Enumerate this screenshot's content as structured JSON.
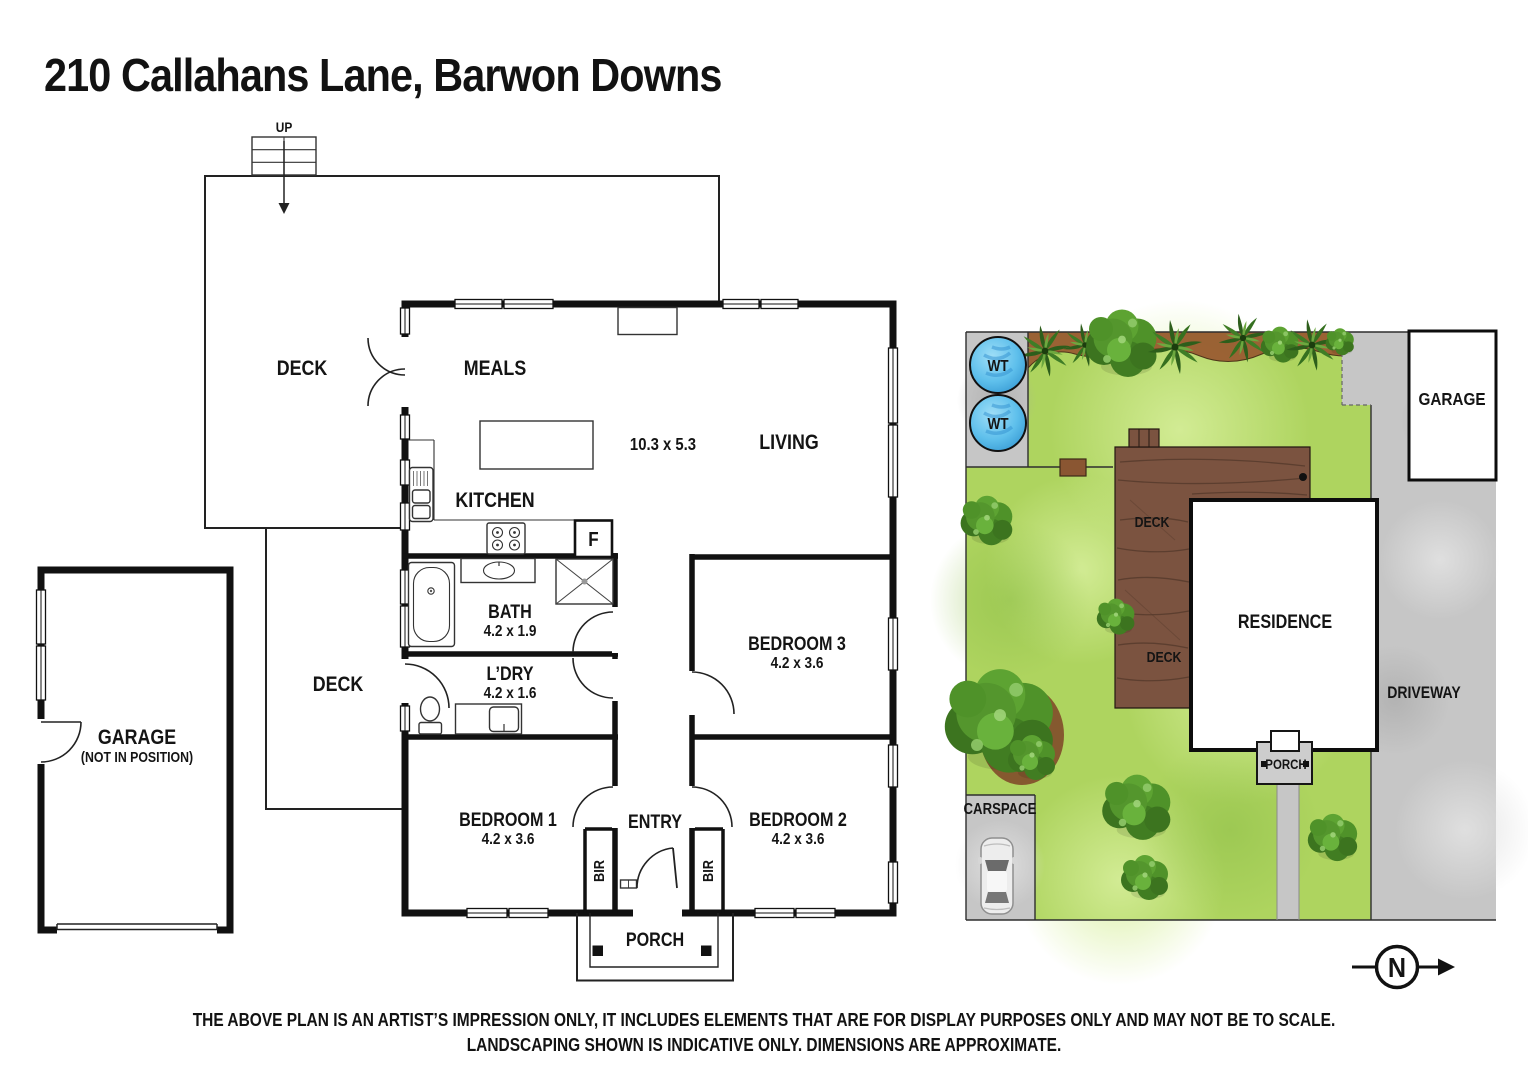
{
  "title": "210 Callahans Lane, Barwon Downs",
  "floor_plan": {
    "labels": {
      "up": "UP",
      "deck_upper": "DECK",
      "meals": "MEALS",
      "living": "LIVING",
      "living_dims": "10.3 x 5.3",
      "kitchen": "KITCHEN",
      "fridge": "F",
      "bath": "BATH",
      "bath_dims": "4.2 x 1.9",
      "laundry": "L’DRY",
      "laundry_dims": "4.2 x 1.6",
      "deck_side": "DECK",
      "bedroom3": "BEDROOM 3",
      "bedroom3_dims": "4.2 x 3.6",
      "bedroom1": "BEDROOM 1",
      "bedroom1_dims": "4.2 x 3.6",
      "bedroom2": "BEDROOM 2",
      "bedroom2_dims": "4.2 x 3.6",
      "entry": "ENTRY",
      "bir_left": "BIR",
      "bir_right": "BIR",
      "porch": "PORCH",
      "garage": "GARAGE",
      "garage_note": "(NOT IN POSITION)"
    }
  },
  "site_plan": {
    "labels": {
      "wt1": "WT",
      "wt2": "WT",
      "garage": "GARAGE",
      "deck_upper": "DECK",
      "deck_lower": "DECK",
      "residence": "RESIDENCE",
      "driveway": "DRIVEWAY",
      "porch": "PORCH",
      "carspace": "CARSPACE"
    },
    "colors": {
      "lawn": "#aed45f",
      "deck": "#7b5340",
      "concrete": "#c6c6c6",
      "water_tank": "#5fc0ec",
      "garden_bed": "#9a5f33",
      "tree_dark": "#3c741f",
      "tree_light": "#5da332",
      "walls": "#111111"
    }
  },
  "compass": {
    "label": "N"
  },
  "disclaimer": {
    "line1": "THE ABOVE PLAN IS AN ARTIST’S IMPRESSION ONLY, IT INCLUDES ELEMENTS THAT ARE FOR DISPLAY PURPOSES ONLY AND MAY NOT BE TO SCALE.",
    "line2": "LANDSCAPING SHOWN IS INDICATIVE ONLY. DIMENSIONS ARE APPROXIMATE."
  }
}
